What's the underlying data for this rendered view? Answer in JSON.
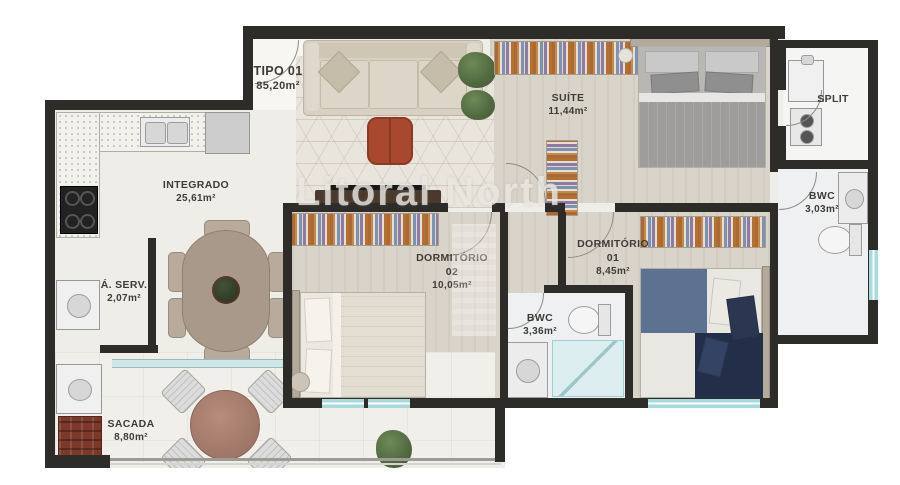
{
  "watermark": "Litoral North",
  "unit": {
    "name": "TIPO 01",
    "area": "85,20m²"
  },
  "rooms": {
    "suite": {
      "name": "SUÍTE",
      "area": "11,44m²"
    },
    "split": {
      "name": "SPLIT"
    },
    "bwc_suite": {
      "name": "BWC",
      "area": "3,03m²"
    },
    "integrado": {
      "name": "INTEGRADO",
      "area": "25,61m²"
    },
    "dorm02": {
      "name": "DORMITÓRIO",
      "number": "02",
      "area": "10,05m²"
    },
    "dorm01": {
      "name": "DORMITÓRIO",
      "number": "01",
      "area": "8,45m²"
    },
    "servico": {
      "name": "Á. SERV.",
      "area": "2,07m²"
    },
    "bwc_social": {
      "name": "BWC",
      "area": "3,36m²"
    },
    "sacada": {
      "name": "SACADA",
      "area": "8,80m²"
    }
  },
  "colors": {
    "wall": "#2e2c29",
    "floor": "#efede8",
    "room_floor": "#d9d4c9",
    "bath_floor": "#eef0f1",
    "sacada_floor": "#f1efe9",
    "window": "#a7dbde",
    "wardrobe_base": "#cdbfa9",
    "sofa": "#d8d0c2",
    "pouf": "#a8492f",
    "table": "#a9998a",
    "balcony_table": "#b68c7c",
    "quilt_blue": "#5d7191",
    "quilt_navy": "#232e49",
    "red_cabinet": "#7c392a",
    "label_color": "#3e3b38",
    "watermark_color": "#e9e7e2"
  }
}
